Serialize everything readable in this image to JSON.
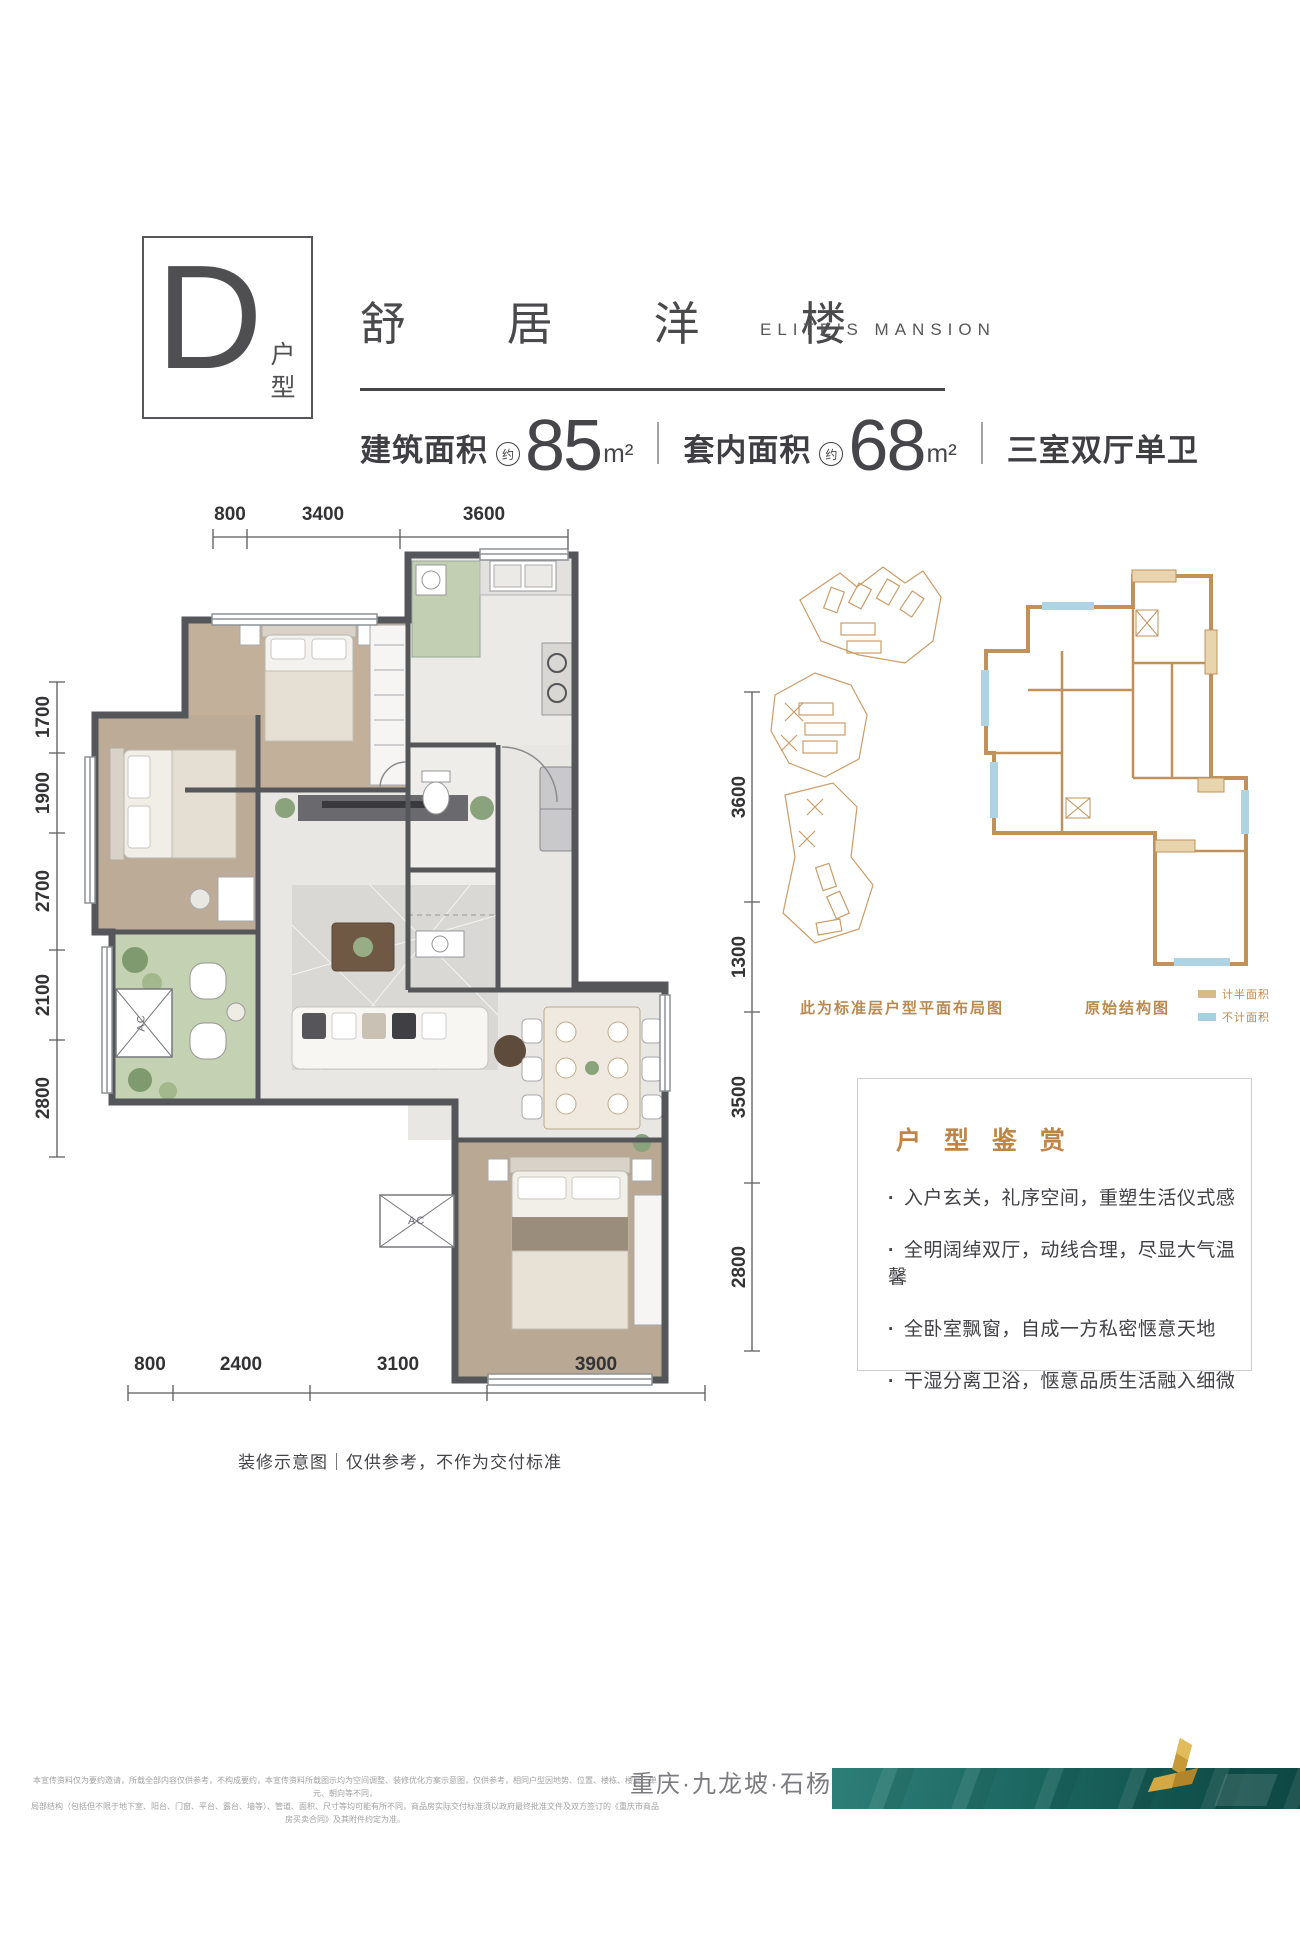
{
  "header": {
    "unit_letter": "D",
    "unit_label": "户型",
    "title_cn": "舒 居 洋 楼",
    "title_en": "ELITE'S MANSION",
    "specs": {
      "area1_label": "建筑面积",
      "area1_approx": "约",
      "area1_value": "85",
      "area1_unit": "m²",
      "area2_label": "套内面积",
      "area2_approx": "约",
      "area2_value": "68",
      "area2_unit": "m²",
      "layout_text": "三室双厅单卫"
    }
  },
  "floorplan": {
    "dims_top": [
      "800",
      "3400",
      "3600"
    ],
    "dims_left": [
      "1700",
      "1900",
      "2700",
      "2100",
      "2800"
    ],
    "dims_right": [
      "3600",
      "1300",
      "3500",
      "2800"
    ],
    "dims_bottom": [
      "800",
      "2400",
      "3100",
      "3900"
    ],
    "ac_label": "AC",
    "caption": "装修示意图｜仅供参考，不作为交付标准"
  },
  "sidebar": {
    "siteplan_caption": "此为标准层户型平面布局图",
    "structure_caption": "原始结构图",
    "legend": [
      {
        "label": "计半面积",
        "color": "#d6b98c"
      },
      {
        "label": "不计面积",
        "color": "#a9d0e2"
      }
    ],
    "review": {
      "title": "户 型 鉴 赏",
      "bullets": [
        "入户玄关，礼序空间，重塑生活仪式感",
        "全明阔绰双厅，动线合理，尽显大气温馨",
        "全卧室飘窗，自成一方私密惬意天地",
        "干湿分离卫浴，惬意品质生活融入细微"
      ]
    }
  },
  "footer": {
    "disclaimer_line1": "本宣传资料仅为要约邀请，所载全部内容仅供参考，不构成要约，本宣传资料所载图示均为空间调整、装修优化方案示意图，仅供参考，相同户型因地势、位置、楼栋、楼层、单元、朝向等不同，",
    "disclaimer_line2": "局部结构（包括但不限于地下室、阳台、门窗、平台、露台、墙等）、管道、面积、尺寸等均可能有所不同，商品房实际交付标准须以政府最终批准文件及双方签订的《重庆市商品房买卖合同》及其附件约定为准。",
    "location": "重庆·九龙坡·石杨路",
    "accent_teal": "#1b655f",
    "accent_gold": "#c3932f"
  }
}
